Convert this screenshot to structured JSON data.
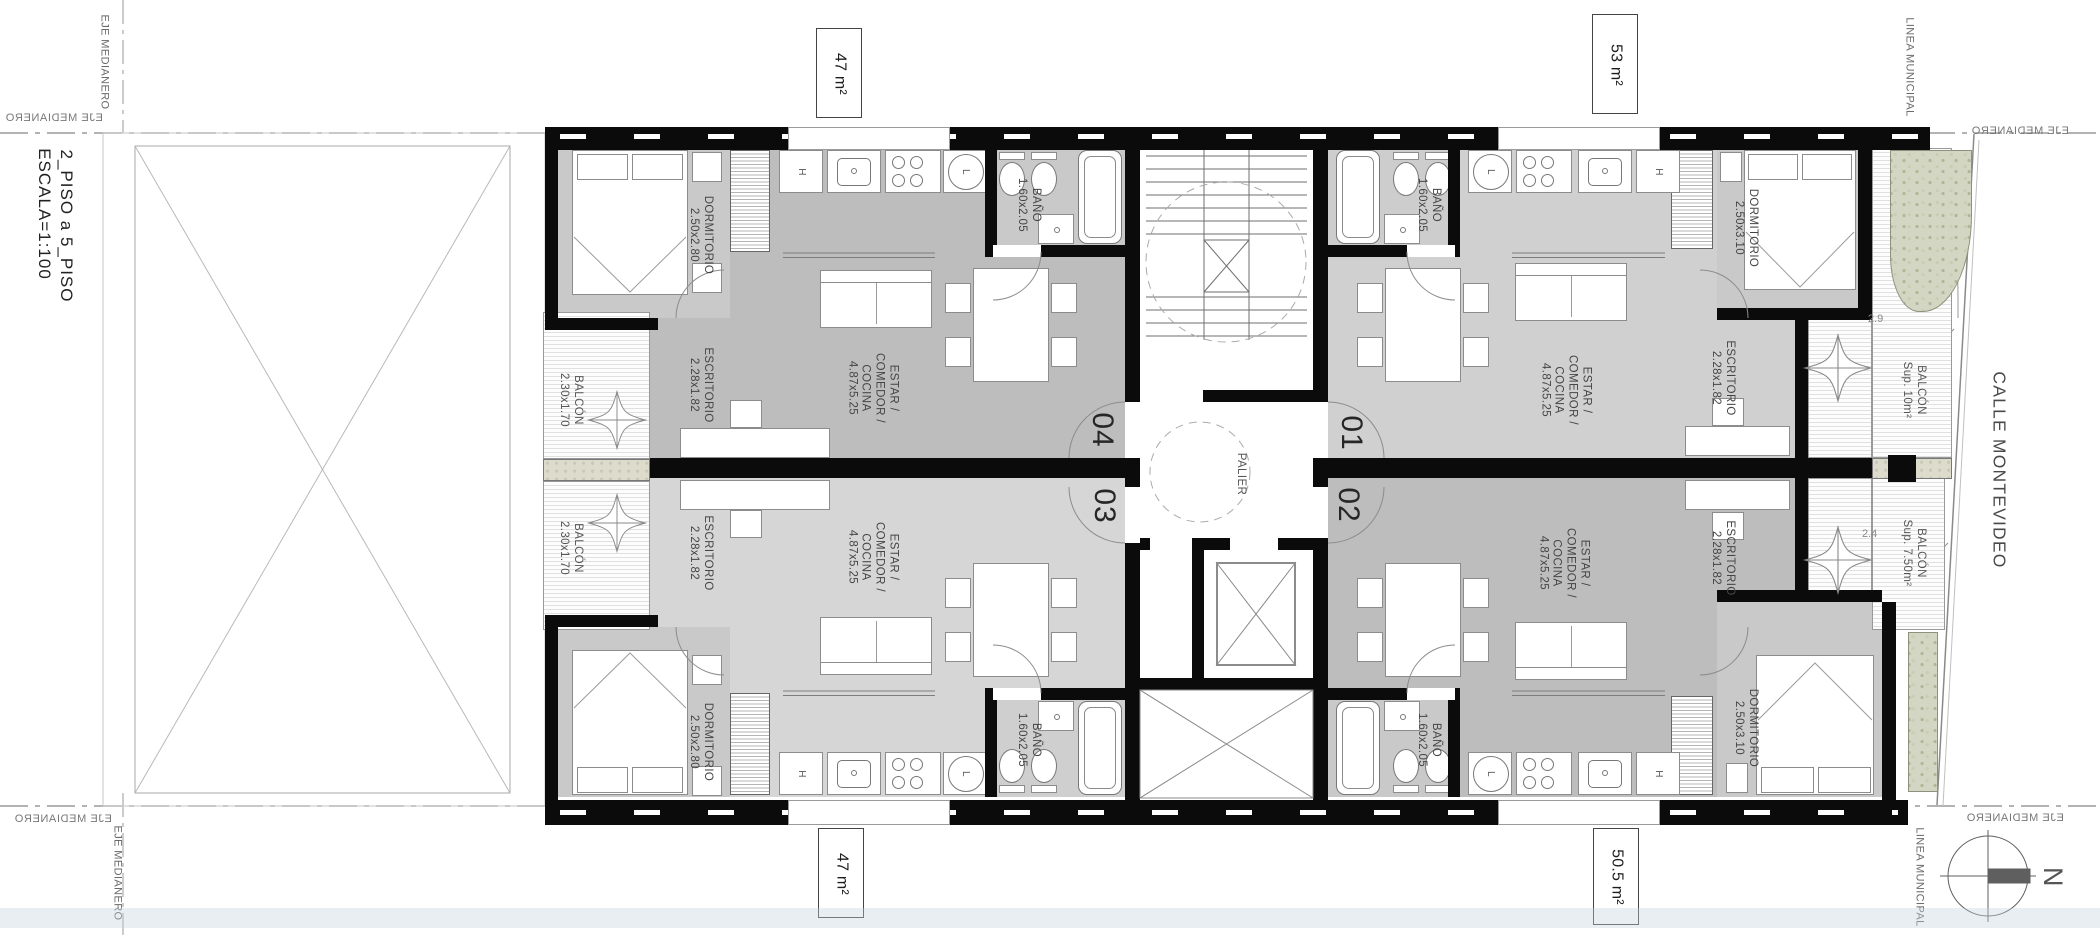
{
  "title": {
    "line1": "2_PISO a 5_PISO",
    "line2": "ESCALA=1:100"
  },
  "boundaries": {
    "eje_medianero": "EJE MEDIANERO",
    "linea_municipal": "LINEA MUNICIPAL",
    "calle": "CALLE MONTEVIDEO",
    "north": "N"
  },
  "area_labels": {
    "top_left": "47 m²",
    "top_right": "53 m²",
    "bottom_left": "47 m²",
    "bottom_right": "50.5 m²"
  },
  "core": {
    "palier": "PALIER"
  },
  "kitchen": {
    "horno": "H",
    "heladera": "L"
  },
  "apartments": {
    "a04": {
      "unit": "04",
      "dormitorio": "DORMITORIO",
      "dormitorio_dim": "2.50x2.80",
      "escritorio": "ESCRITORIO",
      "escritorio_dim": "2.28x1.82",
      "estar1": "ESTAR /",
      "estar2": "COMEDOR /",
      "estar3": "COCINA",
      "estar_dim": "4.87x5.25",
      "bano": "BAÑO",
      "bano_dim": "1.60x2.05",
      "balcon": "BALCÓN",
      "balcon_dim": "2.30x1.70"
    },
    "a03": {
      "unit": "03",
      "dormitorio": "DORMITORIO",
      "dormitorio_dim": "2.50x2.80",
      "escritorio": "ESCRITORIO",
      "escritorio_dim": "2.28x1.82",
      "estar1": "ESTAR /",
      "estar2": "COMEDOR /",
      "estar3": "COCINA",
      "estar_dim": "4.87x5.25",
      "bano": "BAÑO",
      "bano_dim": "1.60x2.05",
      "balcon": "BALCÓN",
      "balcon_dim": "2.30x1.70"
    },
    "a01": {
      "unit": "01",
      "dormitorio": "DORMITORIO",
      "dormitorio_dim": "2.50x3.10",
      "escritorio": "ESCRITORIO",
      "escritorio_dim": "2.28x1.82",
      "estar1": "ESTAR /",
      "estar2": "COMEDOR /",
      "estar3": "COCINA",
      "estar_dim": "4.87x5.25",
      "bano": "BAÑO",
      "bano_dim": "1.60x2.05",
      "balcon": "BALCÓN",
      "balcon_sup": "Sup. 10m²",
      "balcon_width": "2.9"
    },
    "a02": {
      "unit": "02",
      "dormitorio": "DORMITORIO",
      "dormitorio_dim": "2.50x3.10",
      "escritorio": "ESCRITORIO",
      "escritorio_dim": "2.28x1.82",
      "estar1": "ESTAR /",
      "estar2": "COMEDOR /",
      "estar3": "COCINA",
      "estar_dim": "4.87x5.25",
      "bano": "BAÑO",
      "bano_dim": "1.60x2.05",
      "balcon": "BALCÓN",
      "balcon_sup": "Sup. 7.50m²",
      "balcon_width": "2.4"
    }
  }
}
